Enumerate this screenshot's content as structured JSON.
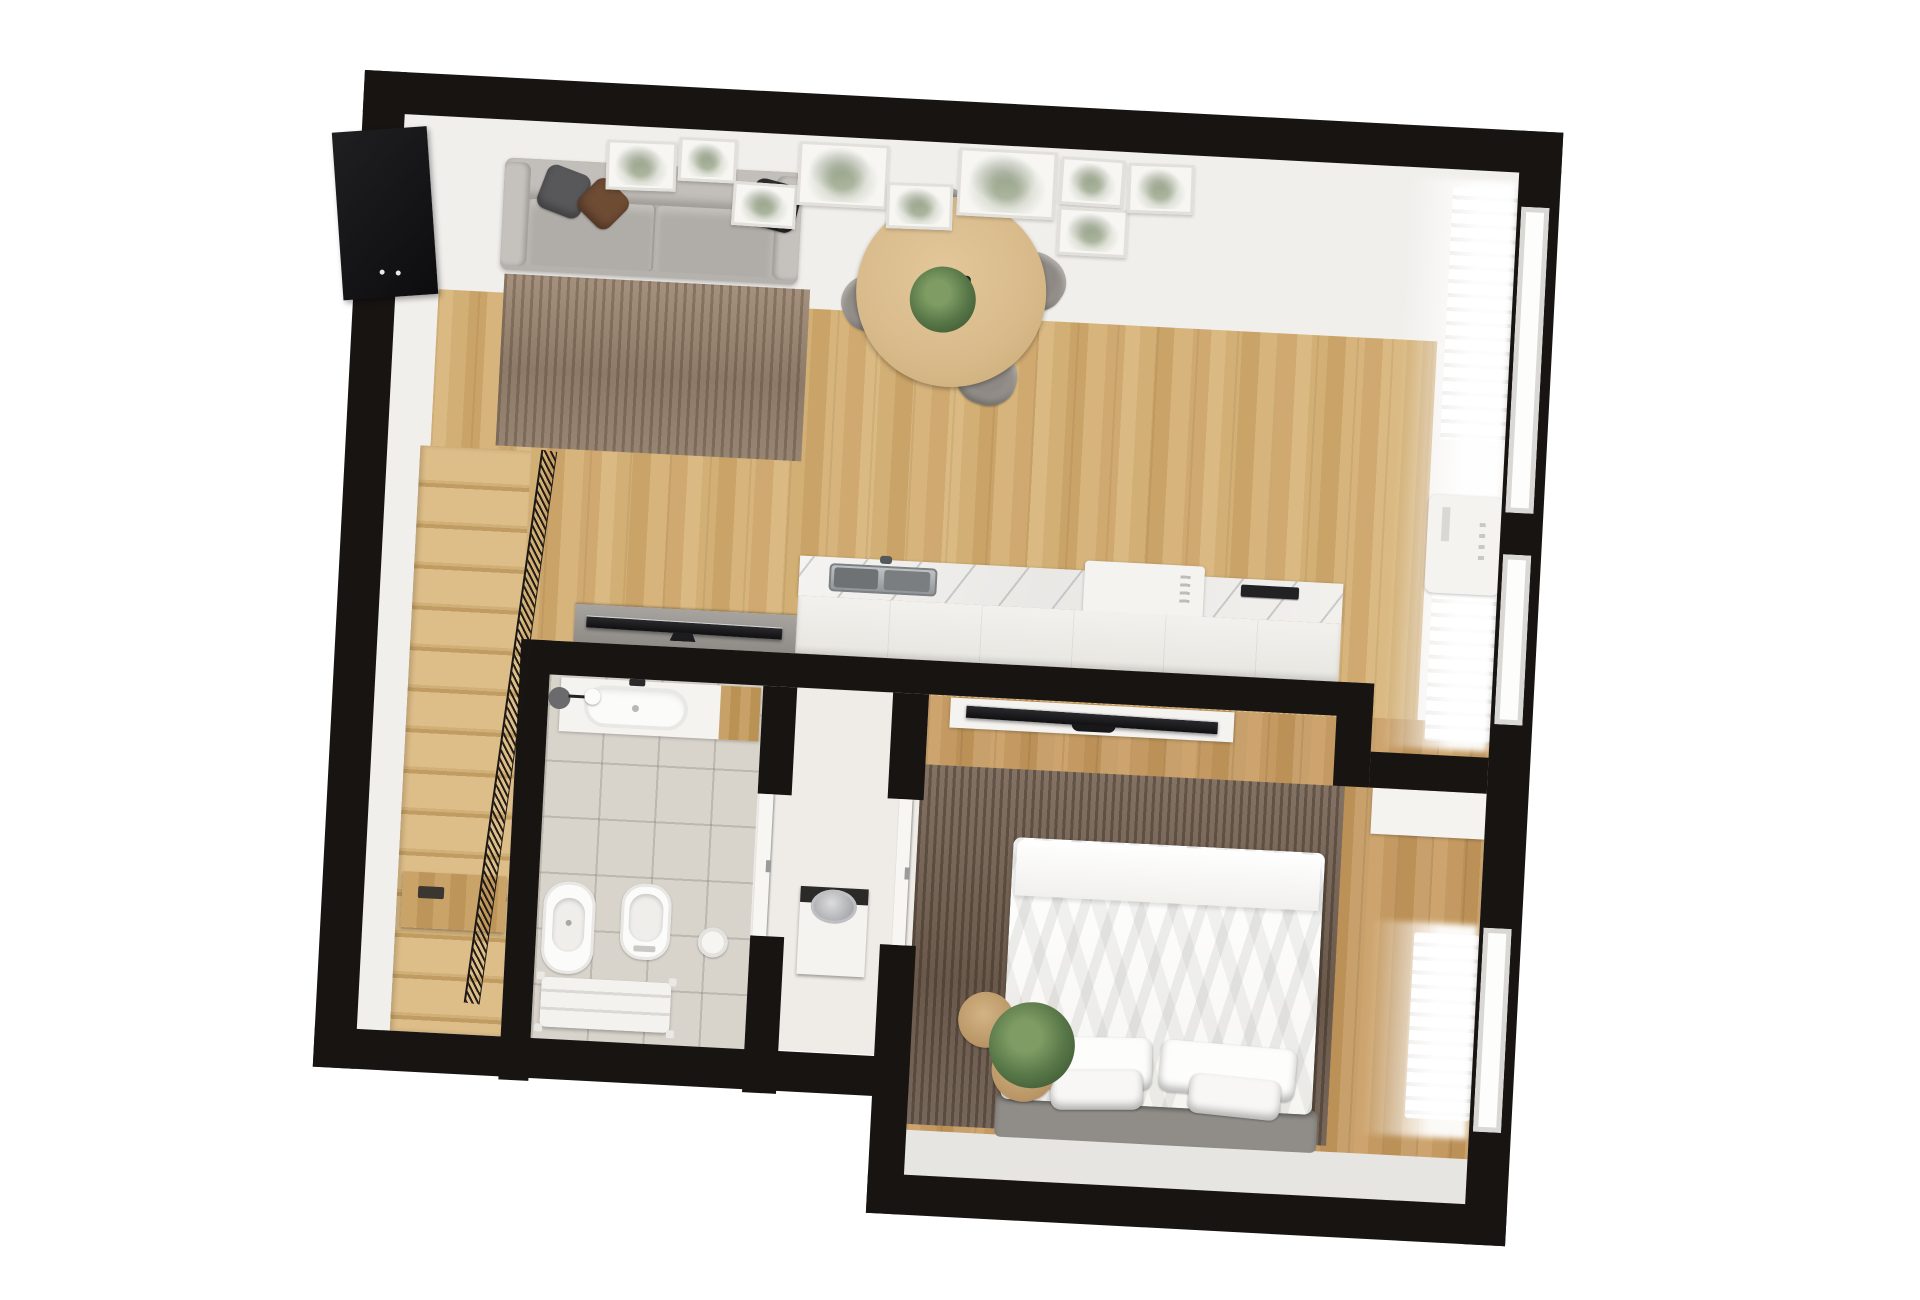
{
  "scene": {
    "type": "3d-floor-plan-top-down-render",
    "background_color": "#ffffff",
    "plan_rotation_deg": 3,
    "wall_color": "#171412"
  },
  "palette": {
    "wood_living": "#d2ae74",
    "wood_bedroom": "#c49a62",
    "plaster_white": "#f1efec",
    "bathroom_tile": "#d8d3cb",
    "hall_floor": "#efece7",
    "living_rug": "#97867a",
    "bedroom_rug": "#6e5e51",
    "sofa_gray": "#b7b3ae",
    "chair_gray": "#95908a",
    "table_wood": "#dec192",
    "marble_counter": "#eceae6",
    "cabinet_white": "#f2f0ec",
    "bed_linen_white": "#fcfcfb",
    "plant_green": "#5c7a4a",
    "pouf_tan": "#c9a876",
    "tv_black": "#151517",
    "metal_gray": "#c8c8ca"
  },
  "rooms": [
    {
      "id": "living-dining-kitchen",
      "label": "open plan living, dining and kitchen"
    },
    {
      "id": "staircase",
      "label": "staircase with mesh railing"
    },
    {
      "id": "bathroom",
      "label": "bathroom"
    },
    {
      "id": "hallway",
      "label": "entry hallway"
    },
    {
      "id": "bedroom",
      "label": "bedroom"
    }
  ],
  "furniture": {
    "living": [
      "corner wall tv",
      "gallery picture frames",
      "three seat sofa",
      "throw pillows",
      "area rug",
      "media console with tv"
    ],
    "dining": [
      "round wood table",
      "four upholstered chairs",
      "table plant centerpiece"
    ],
    "kitchen": [
      "marble countertop",
      "stainless sink",
      "countertop appliance",
      "cooktop",
      "white cabinets"
    ],
    "right_wall": [
      "windows",
      "sheer curtains",
      "radiators",
      "wall mounted ac unit"
    ],
    "staircase": [
      "wood treads",
      "black mesh railing",
      "lower wood shelf"
    ],
    "bathroom": [
      "vanity with oval sink",
      "wall lamp",
      "bidet",
      "toilet",
      "towel bench",
      "round canister",
      "open door"
    ],
    "hallway": [
      "laundry bin with metal lid",
      "open bedroom door"
    ],
    "bedroom": [
      "double bed with white duvet",
      "four pillows",
      "upholstered bed frame",
      "dark rug",
      "floating tv shelf",
      "tv",
      "led strip",
      "two round poufs",
      "floor plant",
      "radiator",
      "closet shelf"
    ]
  },
  "counts": {
    "gallery_frames": 9,
    "dining_chairs": 4,
    "sofa_pillows": 3,
    "bed_pillows": 4,
    "stair_treads": 15,
    "poufs": 2,
    "windows": 3,
    "radiator_segments": 3
  }
}
